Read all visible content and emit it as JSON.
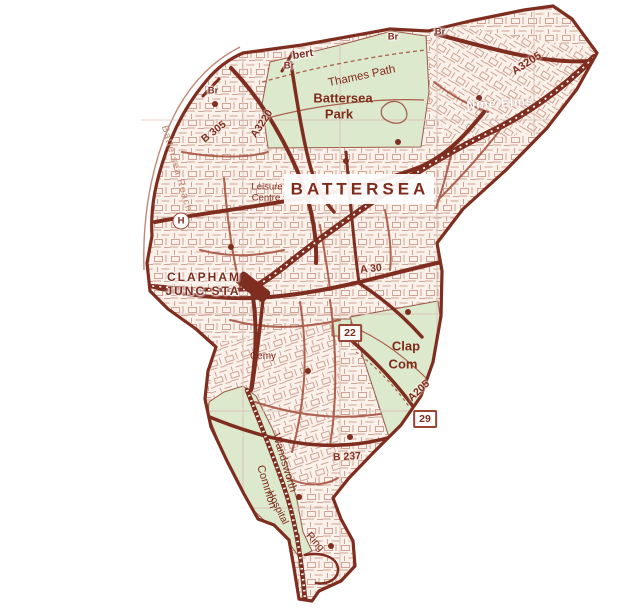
{
  "title": "Battersea street map",
  "colors": {
    "map_red": "#9a4434",
    "bold_road": "#7e2d1f",
    "mid_road": "#a65341",
    "park_green": "#dde9cd",
    "street_fill": "#faf2ea",
    "label_text": "#7f2b1c",
    "river_text": "#c08976",
    "grid_line": "#d9c5bb",
    "label_band": "#ffffff"
  },
  "labels": {
    "battersea": "BATTERSEA",
    "battersea_park_1": "Battersea",
    "battersea_park_2": "Park",
    "thames_path": "Thames Path",
    "albert": "bert",
    "br": "Br",
    "battersea_reach": "Battersea Reach",
    "leisure_centre_1": "Leisure",
    "leisure_centre_2": "Centre",
    "clapham_junction_1": "CLAPHAM",
    "clapham_junction_2": "JUNC STA",
    "nine_elms": "Nine Elms",
    "cemy": "Cemy",
    "clapham_common_1": "Clap",
    "clapham_common_2": "Com",
    "wandsworth_common_1": "Wandsworth",
    "wandsworth_common_2": "Common",
    "hospital": "Hospital",
    "ring": "Ring"
  },
  "roads": {
    "a3205": "A3205",
    "a3220": "A3220",
    "b305": "B 305",
    "a30": "A 30",
    "b237": "B 237",
    "a205": "A205",
    "badge_22": "22",
    "badge_29": "29"
  },
  "icons": {
    "hospital_symbol": "H"
  }
}
